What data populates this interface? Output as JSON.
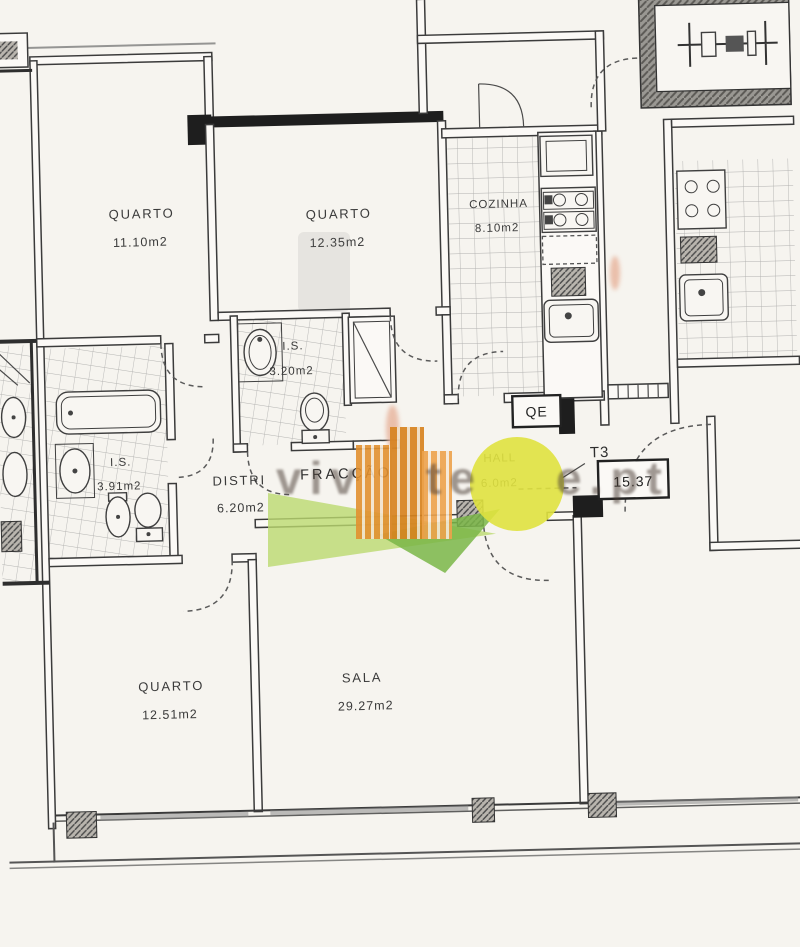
{
  "rooms": [
    {
      "name": "QUARTO",
      "area": "11.10m2"
    },
    {
      "name": "QUARTO",
      "area": "12.35m2"
    },
    {
      "name": "COZINHA",
      "area": "8.10m2"
    },
    {
      "name": "I.S.",
      "area": "3.20m2"
    },
    {
      "name": "I.S.",
      "area": "3.91m2"
    },
    {
      "name": "DISTRI",
      "area": "6.20m2"
    },
    {
      "name": "HALL",
      "area": "6.0m2"
    },
    {
      "name": "QUARTO",
      "area": "12.51m2"
    },
    {
      "name": "SALA",
      "area": "29.27m2"
    }
  ],
  "annotations": {
    "fraction_label": "FRACÇÃO",
    "unit_type": "T3",
    "level_value": "15.37",
    "electrical_panel": "QE"
  },
  "watermark": {
    "fragments": [
      "viv",
      "te",
      "e.pt"
    ],
    "colors": {
      "building": "#e2902f",
      "sun": "#e0e23f",
      "leaf": "#bcd96f",
      "leaf_dark": "#7ab648",
      "text": "#4a3e36"
    }
  },
  "palette": {
    "paper": "#f6f4ef",
    "ink": "#3b3b3b",
    "wall": "#1e1e1e",
    "tile_line": "#999999"
  }
}
